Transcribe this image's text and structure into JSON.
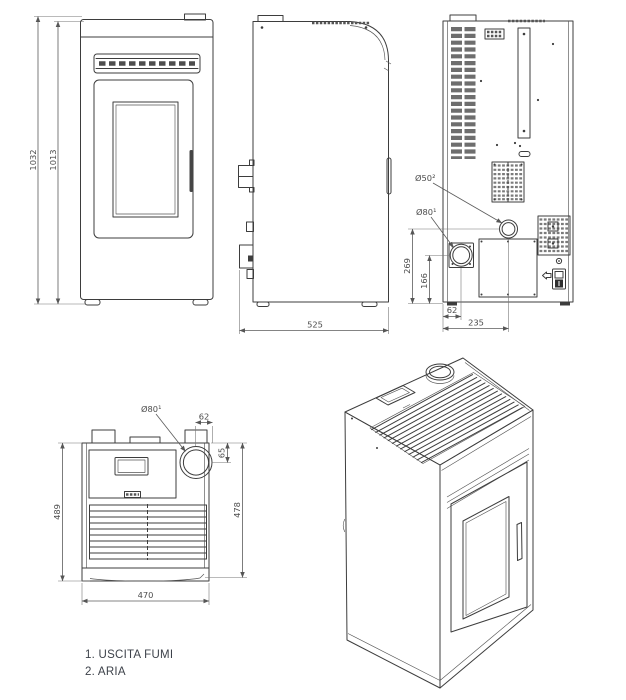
{
  "colors": {
    "background": "#ffffff",
    "line": "#3d3d3d",
    "dimension": "#565656",
    "legend_text": "#3d424a"
  },
  "views": {
    "front": {
      "dim_overall_height": "1032",
      "dim_body_height": "1013"
    },
    "side": {
      "dim_depth": "525"
    },
    "rear": {
      "label_air_inlet": "Ø50²",
      "label_flue_outlet": "Ø80¹",
      "dim_air_inlet_height": "269",
      "dim_flue_outlet_height": "166",
      "dim_flue_outlet_offset": "62",
      "dim_air_inlet_offset": "235"
    },
    "top": {
      "label_flue_outlet": "Ø80¹",
      "dim_flue_offset_side": "62",
      "dim_flue_offset_rear": "65",
      "dim_depth_overall": "489",
      "dim_depth_body": "478",
      "dim_width": "470"
    }
  },
  "legend": {
    "items": [
      "1. USCITA FUMI",
      "2. ARIA"
    ]
  }
}
